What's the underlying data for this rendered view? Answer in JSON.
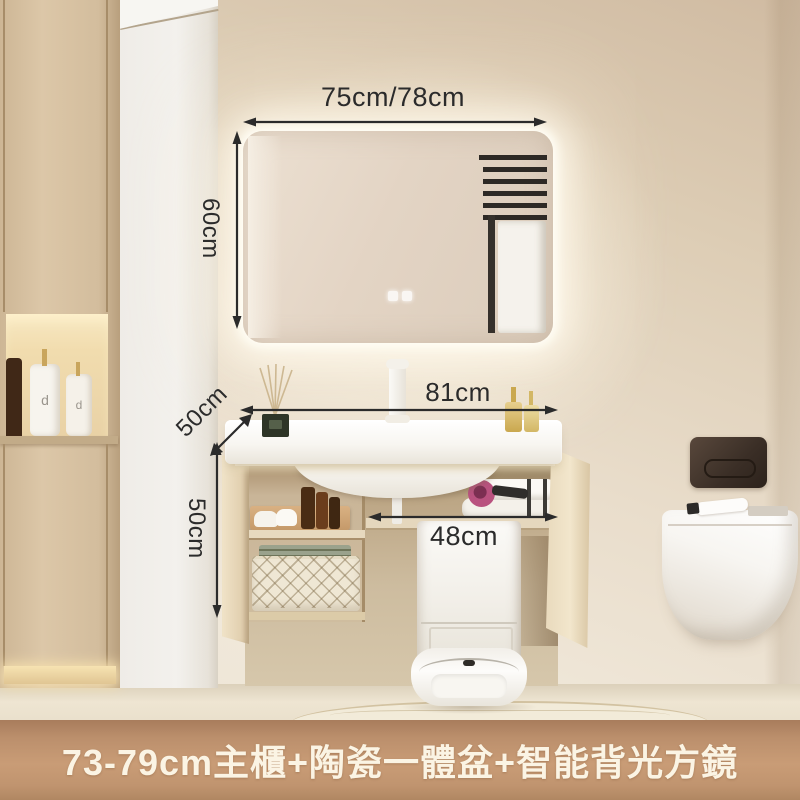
{
  "annotations": {
    "mirror_width": "75cm/78cm",
    "mirror_height": "60cm",
    "counter_width": "81cm",
    "counter_depth": "50cm",
    "cabinet_height": "50cm",
    "clearance_width": "48cm",
    "text_color": "#2b2b2b"
  },
  "caption": {
    "text": "73-79cm主櫃+陶瓷一體盆+智能背光方鏡",
    "background_color": "#c0946f",
    "text_color": "#fbf4e4"
  },
  "decor": {
    "bottle_letter": "d"
  },
  "icons": {
    "mirror_touch_buttons": "two-rounded-square-touch-glyphs",
    "dimension_arrows": "double-headed-measurement-arrows"
  },
  "palette": {
    "wall": "#e7dbc9",
    "cabinet_wood": "#d6c1a1",
    "niche_glow": "#f3dfae",
    "ceramic_white": "#fbfaf7",
    "flush_plate": "#3a2e26"
  }
}
